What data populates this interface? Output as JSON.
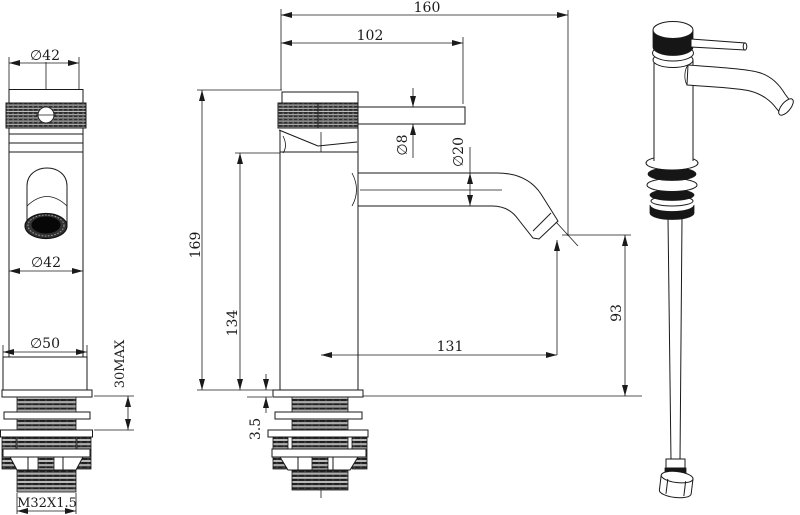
{
  "drawing": {
    "title": "faucet-technical-drawing",
    "front": {
      "top_diameter": "∅42",
      "spout_diameter": "∅42",
      "base_diameter": "∅50",
      "max_mounting_thickness": "30MAX",
      "thread_spec": "M32X1.5"
    },
    "side": {
      "overall_length": "160",
      "handle_length": "102",
      "handle_rod_diameter": "∅8",
      "spout_tube_diameter": "∅20",
      "overall_height": "169",
      "body_height": "134",
      "spout_reach": "131",
      "outlet_height": "93",
      "flange_thickness": "3.5"
    },
    "colors": {
      "line": "#1a1a1a",
      "background": "#ffffff"
    }
  }
}
